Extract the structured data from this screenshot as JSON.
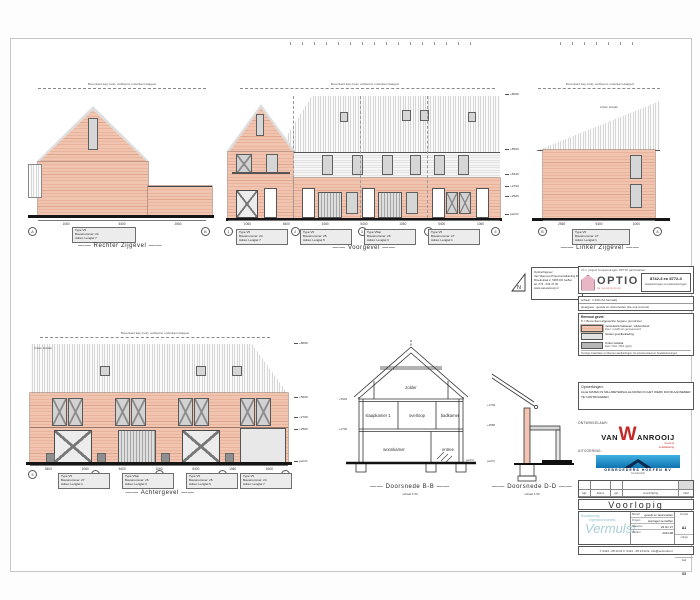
{
  "sheet": {
    "top_note": "Bovenkant kap (nok), wolfseind, onderkant dakgoot",
    "roof_note": "zinken felsdak",
    "status": "Voorlopig"
  },
  "captions": {
    "rechter": "Rechter Zijgevel",
    "voorgevel": "Voorgevel",
    "linker": "Linker Zijgevel",
    "achtergevel": "Achtergevel",
    "doorsnede_bb": "Doorsnede B-B",
    "doorsnede_dd": "Doorsnede D-D",
    "section_scale": "schaal 1:50"
  },
  "rooms": {
    "zolder": "zolder",
    "slaapkamer": "slaapkamer 1",
    "overloop": "overloop",
    "badkamer": "badkamer",
    "woonkamer": "woonkamer",
    "entree": "entree"
  },
  "levels": {
    "p0": "peil=0",
    "v2580": "+2580",
    "v2700": "+2700",
    "v5340": "+5340"
  },
  "tags": {
    "rechter": [
      "Type V5",
      "Bouwnummer: 24",
      "Adres: Lengtel 7"
    ],
    "linker": [
      "Type V5",
      "Bouwnummer: 27",
      "Adres: Lengtel 1"
    ],
    "voorgevel": [
      [
        "Type V5",
        "Bouwnummer: 24",
        "Adres: Lengtel 7"
      ],
      [
        "Type V5",
        "Bouwnummer: 25",
        "Adres: Lengtel 5"
      ],
      [
        "Type V5sp",
        "Bouwnummer: 26",
        "Adres: Lengtel 3"
      ],
      [
        "Type V5",
        "Bouwnummer: 27",
        "Adres: Lengtel 1"
      ]
    ],
    "achtergevel": [
      [
        "Type V5",
        "Bouwnummer: 27",
        "Adres: Lengtel 1"
      ],
      [
        "Type V5sp",
        "Bouwnummer: 26",
        "Adres: Lengtel 3"
      ],
      [
        "Type V5",
        "Bouwnummer: 25",
        "Adres: Lengtel 5"
      ],
      [
        "Type V5",
        "Bouwnummer: 24",
        "Adres: Lengtel 7"
      ]
    ]
  },
  "dims": {
    "rechter": [
      "1060",
      "5400",
      "2560"
    ],
    "voorgevel": [
      "1060",
      "5400",
      "1060",
      "5400",
      "1060",
      "5400",
      "1060"
    ],
    "linker": [
      "2560",
      "5400",
      "1060"
    ],
    "achtergevel": [
      "5400",
      "1060",
      "5400",
      "1060",
      "5400",
      "1060",
      "5400"
    ]
  },
  "bubbles": {
    "rechter": [
      "A",
      "B"
    ],
    "voorgevel": [
      "1",
      "2",
      "3",
      "4",
      "5"
    ],
    "linker": [
      "B",
      "A"
    ],
    "achtergevel": [
      "5",
      "4",
      "3",
      "2",
      "1"
    ]
  },
  "peils": [
    "+8090",
    "+5600",
    "+5340",
    "+2700",
    "+2580",
    "peil=0"
  ],
  "peils_achter": [
    "+8090",
    "+5600",
    "+2700",
    "+2580",
    "peil=0"
  ],
  "project": {
    "header_line": "t.b.v. project 'koopwoningen OPTIO participaties'",
    "brand": "OPTIO",
    "brand_sub": "de woonformule",
    "number": "8742-3 en 8772-3",
    "number_sub": "Hoekwoningen en tussenwoningen",
    "scale_row": "schaal : 1:100 (A1 formaat)",
    "view_row": "weergave : gevels en doorsneden (zie ook renvooi)",
    "peil_row": "P = Bovenkant afgewerkte begane grondvloer"
  },
  "renvooi": {
    "title": "Renvooi gevel:",
    "items": [
      {
        "name": "metselwerk baksteen, wildverband",
        "sub": "kleur: rood/bruin genuanceerd"
      },
      {
        "name": "houten gevelbekleding",
        "sub": ""
      },
      {
        "name": "zinken felsdak",
        "sub": "kleur: RAL 7016 (grijs)"
      }
    ],
    "note": "Overige materialen en kleuren aanduidingen zie exterieurstaat en bestektekeningen"
  },
  "opmerkingen": {
    "title": "Opmerkingen:",
    "lines": [
      "ALLE MATEN IN MILLIMETERS",
      "ALLE MATEN IN HET WERK DOOR AANNEMER TE CONTROLEREN"
    ]
  },
  "client": {
    "lines": [
      "Opdrachtgever:",
      "Van Wanrooij Projectontwikkeling B.V.",
      "Broekstraat 2, 5386 KD Geffen",
      "tel. 073 - 534 47 00",
      "www.vanwanrooij.nl"
    ]
  },
  "parties": {
    "ontwikkelaar_label": "ONTWIKKELAAR:",
    "uitvoering_label": "UITVOERING:",
    "wanrooij": {
      "pre": "VAN",
      "w": "W",
      "post": "ANROOIJ",
      "sub1": "bouw &",
      "sub2": "ontwikkeling"
    },
    "gebroeders": {
      "name": "GEBROEDERS HOEFEN BV",
      "sub": "bouwbedrijf"
    }
  },
  "revision": {
    "headers": [
      "wijz.",
      "datum",
      "get.",
      "omschrijving",
      "blad"
    ]
  },
  "titleblock": {
    "status": "Voorlopig",
    "vermulst": {
      "l1": "Bouwkundig",
      "l2": "Ingenieursbureau",
      "name": "Vermulst"
    },
    "rows": [
      [
        "Betreft",
        "gevels en doorsneden"
      ],
      [
        "Project",
        "woningen te Geffen"
      ],
      [
        "Bouwnrs.",
        "24 t/m 27"
      ],
      [
        "Werknr.",
        "2013-08"
      ]
    ],
    "side": [
      [
        "formaat",
        "A1"
      ],
      [
        "schaal",
        "1:100"
      ],
      [
        "blad",
        "03"
      ]
    ],
    "contact": "T. 0413 - 28 13 01    F. 0413 - 28 13 02    E. info@vermulst.nl"
  },
  "colors": {
    "brick": "#f1c4b0",
    "accent_red": "#c62828",
    "accent_blue": "#0f74b0",
    "optio_pink": "#e9b6c6",
    "vermulst_teal": "#a9cdd8"
  }
}
